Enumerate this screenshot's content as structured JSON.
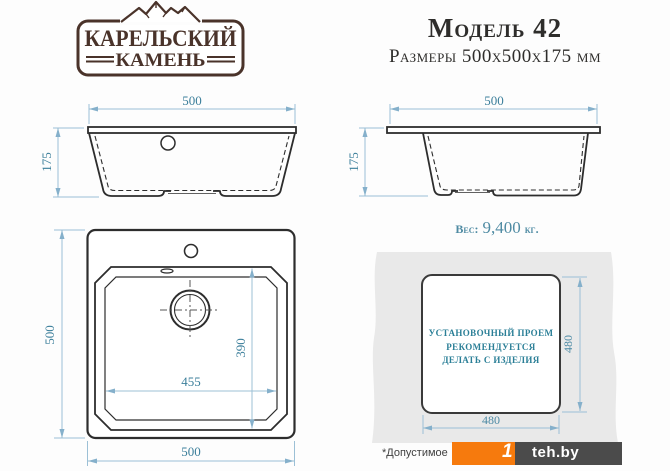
{
  "logo": {
    "line1": "КАРЕЛЬСКИЙ",
    "line2": "КАМЕНЬ"
  },
  "header": {
    "model": "Модель 42",
    "size_line": "Размеры 500х500х175 мм"
  },
  "front_view": {
    "dim_width": "500",
    "dim_height": "175"
  },
  "side_view": {
    "dim_width": "500",
    "dim_height": "175"
  },
  "weight": {
    "label": "Вес:",
    "value": "9,400",
    "unit": "кг."
  },
  "top_view": {
    "dim_left": "500",
    "dim_bottom": "500",
    "dim_bowl_width": "455",
    "dim_bowl_depth": "390"
  },
  "cutout_view": {
    "dim_right": "480",
    "dim_bottom": "480",
    "note_lines": [
      "УСТАНОВОЧНЫЙ ПРОЕМ",
      "РЕКОМЕНДУЕТСЯ",
      "ДЕЛАТЬ С ИЗДЕЛИЯ"
    ]
  },
  "footer": {
    "note": "*Допустимое",
    "watermark_digit": "1",
    "watermark_text": "teh.by"
  },
  "colors": {
    "drawing_line": "#2d2d2d",
    "dimension_line": "#9cc0d6",
    "dimension_text": "#3c7f9b",
    "note_teal": "#2b7f97",
    "weight_teal": "#4f8ba3",
    "logo_brown": "#4a332a",
    "countertop_gray": "#e9e9e9",
    "watermark_orange": "#f67a0d",
    "watermark_dark": "#4b4b4b"
  }
}
